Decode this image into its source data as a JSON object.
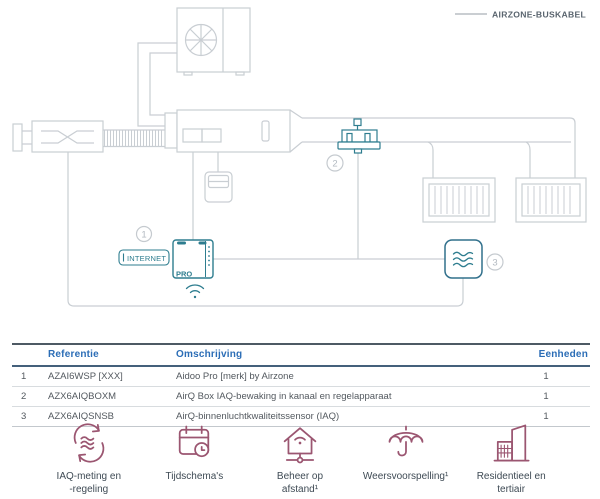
{
  "legend": {
    "label": "AIRZONE-BUSKABEL"
  },
  "diagram": {
    "internet_label": "INTERNET",
    "device_label": "PRO",
    "callout_1": "1",
    "callout_2": "2",
    "callout_3": "3"
  },
  "table": {
    "headers": {
      "reference": "Referentie",
      "description": "Omschrijving",
      "units": "Eenheden"
    },
    "rows": [
      {
        "num": "1",
        "reference": "AZAI6WSP [XXX]",
        "description": "Aidoo Pro [merk] by Airzone",
        "units": "1"
      },
      {
        "num": "2",
        "reference": "AZX6AIQBOXM",
        "description": "AirQ Box IAQ-bewaking in kanaal en regelapparaat",
        "units": "1"
      },
      {
        "num": "3",
        "reference": "AZX6AIQSNSB",
        "description": "AirQ-binnenluchtkwaliteitssensor (IAQ)",
        "units": "1"
      }
    ]
  },
  "features": [
    {
      "icon": "iaq-cycle-icon",
      "label": "IAQ-meting en\n-regeling"
    },
    {
      "icon": "schedule-icon",
      "label": "Tijdschema's"
    },
    {
      "icon": "remote-management-icon",
      "label": "Beheer op\nafstand¹"
    },
    {
      "icon": "weather-forecast-icon",
      "label": "Weersvoorspelling¹"
    },
    {
      "icon": "building-icon",
      "label": "Residentieel en\ntertiair"
    }
  ],
  "colors": {
    "teal": "#2E7D8F",
    "plum": "#9B5671",
    "table_header_blue": "#2B6DB6",
    "line_gray": "#C9CED3"
  }
}
